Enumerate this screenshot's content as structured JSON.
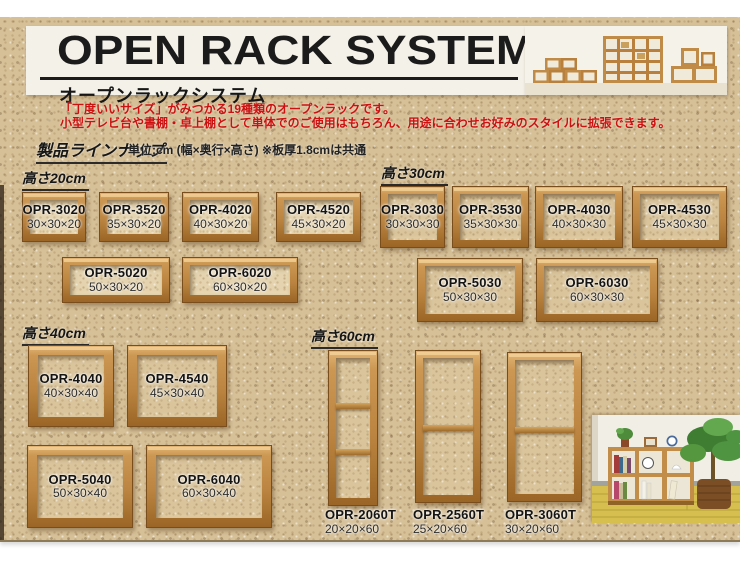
{
  "header": {
    "title": "OPEN RACK SYSTEM",
    "subtitle": "オープンラックシステム"
  },
  "intro": {
    "line1": "「丁度いいサイズ」がみつかる19種類のオープンラックです。",
    "line2": "小型テレビ台や書棚・卓上棚として単体でのご使用はもちろん、用途に合わせお好みのスタイルに拡張できます。"
  },
  "lineup": {
    "heading": "製品ラインナップ",
    "note": "単位:cm (幅×奥行×高さ) ※板厚1.8cmは共通"
  },
  "sections": [
    {
      "heading": "高さ20cm",
      "products": [
        {
          "model": "OPR-3020",
          "size": "30×30×20"
        },
        {
          "model": "OPR-3520",
          "size": "35×30×20"
        },
        {
          "model": "OPR-4020",
          "size": "40×30×20"
        },
        {
          "model": "OPR-4520",
          "size": "45×30×20"
        },
        {
          "model": "OPR-5020",
          "size": "50×30×20"
        },
        {
          "model": "OPR-6020",
          "size": "60×30×20"
        }
      ]
    },
    {
      "heading": "高さ30cm",
      "products": [
        {
          "model": "OPR-3030",
          "size": "30×30×30"
        },
        {
          "model": "OPR-3530",
          "size": "35×30×30"
        },
        {
          "model": "OPR-4030",
          "size": "40×30×30"
        },
        {
          "model": "OPR-4530",
          "size": "45×30×30"
        },
        {
          "model": "OPR-5030",
          "size": "50×30×30"
        },
        {
          "model": "OPR-6030",
          "size": "60×30×30"
        }
      ]
    },
    {
      "heading": "高さ40cm",
      "products": [
        {
          "model": "OPR-4040",
          "size": "40×30×40"
        },
        {
          "model": "OPR-4540",
          "size": "45×30×40"
        },
        {
          "model": "OPR-5040",
          "size": "50×30×40"
        },
        {
          "model": "OPR-6040",
          "size": "60×30×40"
        }
      ]
    },
    {
      "heading": "高さ60cm",
      "products": [
        {
          "model": "OPR-2060T",
          "size": "20×20×60"
        },
        {
          "model": "OPR-2560T",
          "size": "25×20×60"
        },
        {
          "model": "OPR-3060T",
          "size": "30×20×60"
        }
      ]
    }
  ],
  "colors": {
    "cork_background": "#d6c098",
    "wood_frame": "#bb8440",
    "wood_light": "#e2b474",
    "wood_dark": "#7a4e1c",
    "accent_red": "#cc1111",
    "title_black": "#1b1b1b",
    "band_white": "#f4f1e9"
  }
}
